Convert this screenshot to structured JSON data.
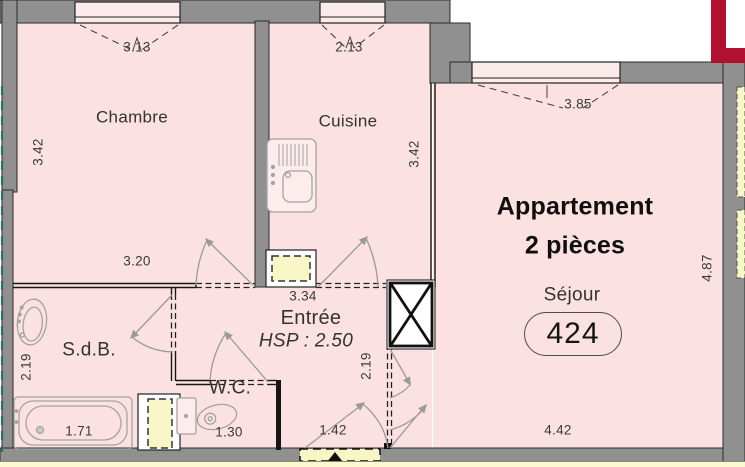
{
  "floorplan": {
    "apartment": {
      "title_line1": "Appartement",
      "title_line2": "2 pièces",
      "unit_number": "424"
    },
    "rooms": {
      "chambre": "Chambre",
      "cuisine": "Cuisine",
      "sejour": "Séjour",
      "sdb": "S.d.B.",
      "wc": "W.C.",
      "entree": "Entrée",
      "entree_ceiling_height": "HSP : 2.50"
    },
    "dimensions": {
      "chambre_window": "3.13",
      "cuisine_window": "2.13",
      "sejour_window": "3.85",
      "chambre_width": "3.20",
      "chambre_height": "3.42",
      "cuisine_height": "3.42",
      "entree_width": "3.34",
      "sdb_height": "2.19",
      "entree_height": "2.19",
      "sejour_height": "4.87",
      "bathtub_length": "1.71",
      "wc_width": "1.30",
      "entree_door": "1.42",
      "sejour_width": "4.42"
    },
    "colors": {
      "room_fill": "#fbe1e1",
      "wall_gray": "#909090",
      "adjacent_unit_red": "#b30f31",
      "duct_yellow": "#f8f5c6",
      "boundary_teal": "#2a6e63"
    }
  }
}
